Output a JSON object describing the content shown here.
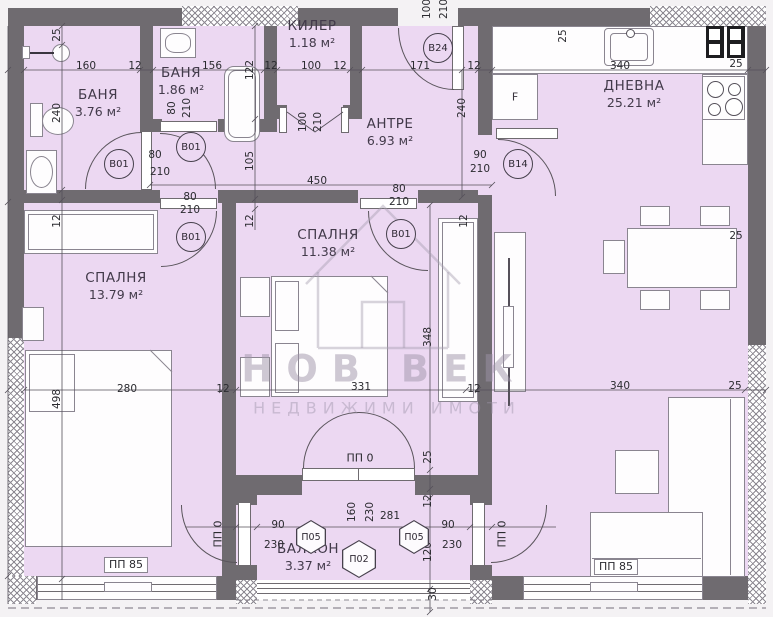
{
  "colors": {
    "floor": "#ecd8f2",
    "wall": "#6f6b70",
    "text": "#423a4a"
  },
  "watermark": {
    "line1": "НОВ ВЕК",
    "line2": "НЕДВИЖИМИ ИМОТИ"
  },
  "fixtures": {
    "fridge_label": "F"
  },
  "rooms": [
    {
      "id": "bath1",
      "name": "БАНЯ",
      "area": "3.76 м²",
      "lx": 98,
      "ly": 96
    },
    {
      "id": "bath2",
      "name": "БАНЯ",
      "area": "1.86 м²",
      "lx": 181,
      "ly": 74
    },
    {
      "id": "closet",
      "name": "КИЛЕР",
      "area": "1.18 м²",
      "lx": 312,
      "ly": 27
    },
    {
      "id": "hall",
      "name": "АНТРЕ",
      "area": "6.93 м²",
      "lx": 390,
      "ly": 125
    },
    {
      "id": "living",
      "name": "ДНЕВНА",
      "area": "25.21 м²",
      "lx": 634,
      "ly": 87
    },
    {
      "id": "bedroom1",
      "name": "СПАЛНЯ",
      "area": "13.79 м²",
      "lx": 116,
      "ly": 279
    },
    {
      "id": "bedroom2",
      "name": "СПАЛНЯ",
      "area": "11.38 м²",
      "lx": 328,
      "ly": 236
    },
    {
      "id": "balcony",
      "name": "БАЛКОН",
      "area": "3.37 м²",
      "lx": 308,
      "ly": 550
    }
  ],
  "badges": [
    {
      "t": "B01",
      "x": 118,
      "y": 163
    },
    {
      "t": "B01",
      "x": 190,
      "y": 146
    },
    {
      "t": "B01",
      "x": 190,
      "y": 236
    },
    {
      "t": "B01",
      "x": 400,
      "y": 233
    },
    {
      "t": "B24",
      "x": 437,
      "y": 47
    },
    {
      "t": "B14",
      "x": 517,
      "y": 163
    }
  ],
  "panels": [
    {
      "t": "П05",
      "x": 311,
      "y": 537,
      "w": 30,
      "h": 34
    },
    {
      "t": "П02",
      "x": 359,
      "y": 559,
      "w": 34,
      "h": 38
    },
    {
      "t": "П05",
      "x": 414,
      "y": 537,
      "w": 30,
      "h": 34
    }
  ],
  "opening_labels": [
    {
      "t": "ПП 85",
      "x": 126,
      "y": 565,
      "boxed": true
    },
    {
      "t": "ПП 85",
      "x": 616,
      "y": 567,
      "boxed": true
    },
    {
      "t": "ПП 0",
      "x": 360,
      "y": 458
    },
    {
      "t": "ПП 0",
      "x": 218,
      "y": 534,
      "r": 1
    },
    {
      "t": "ПП 0",
      "x": 502,
      "y": 534,
      "r": 1
    }
  ],
  "dimensions": [
    {
      "t": "160",
      "x": 86,
      "y": 66
    },
    {
      "t": "12",
      "x": 135,
      "y": 66
    },
    {
      "t": "156",
      "x": 212,
      "y": 66
    },
    {
      "t": "12",
      "x": 271,
      "y": 66
    },
    {
      "t": "100",
      "x": 311,
      "y": 66
    },
    {
      "t": "12",
      "x": 340,
      "y": 66
    },
    {
      "t": "171",
      "x": 420,
      "y": 66
    },
    {
      "t": "12",
      "x": 474,
      "y": 66
    },
    {
      "t": "340",
      "x": 620,
      "y": 66
    },
    {
      "t": "25",
      "x": 736,
      "y": 64
    },
    {
      "t": "25",
      "x": 57,
      "y": 35,
      "r": 1
    },
    {
      "t": "240",
      "x": 57,
      "y": 113,
      "r": 1
    },
    {
      "t": "12",
      "x": 57,
      "y": 221,
      "r": 1
    },
    {
      "t": "498",
      "x": 57,
      "y": 399,
      "r": 1
    },
    {
      "t": "122",
      "x": 250,
      "y": 70,
      "r": 1
    },
    {
      "t": "105",
      "x": 250,
      "y": 161,
      "r": 1
    },
    {
      "t": "12",
      "x": 250,
      "y": 221,
      "r": 1
    },
    {
      "t": "80",
      "x": 172,
      "y": 108,
      "r": 1
    },
    {
      "t": "210",
      "x": 187,
      "y": 108,
      "r": 1
    },
    {
      "t": "100",
      "x": 427,
      "y": 9,
      "r": 1
    },
    {
      "t": "210",
      "x": 444,
      "y": 9,
      "r": 1
    },
    {
      "t": "100",
      "x": 303,
      "y": 122,
      "r": 1
    },
    {
      "t": "210",
      "x": 318,
      "y": 122,
      "r": 1
    },
    {
      "t": "25",
      "x": 563,
      "y": 36,
      "r": 1
    },
    {
      "t": "240",
      "x": 462,
      "y": 108,
      "r": 1
    },
    {
      "t": "80",
      "x": 155,
      "y": 155
    },
    {
      "t": "210",
      "x": 160,
      "y": 172
    },
    {
      "t": "80",
      "x": 190,
      "y": 197
    },
    {
      "t": "210",
      "x": 190,
      "y": 210
    },
    {
      "t": "80",
      "x": 399,
      "y": 189
    },
    {
      "t": "210",
      "x": 399,
      "y": 202
    },
    {
      "t": "90",
      "x": 480,
      "y": 155
    },
    {
      "t": "210",
      "x": 480,
      "y": 169
    },
    {
      "t": "450",
      "x": 317,
      "y": 181
    },
    {
      "t": "12",
      "x": 464,
      "y": 221,
      "r": 1
    },
    {
      "t": "280",
      "x": 127,
      "y": 389
    },
    {
      "t": "12",
      "x": 223,
      "y": 389
    },
    {
      "t": "331",
      "x": 361,
      "y": 387
    },
    {
      "t": "12",
      "x": 474,
      "y": 389
    },
    {
      "t": "340",
      "x": 620,
      "y": 386
    },
    {
      "t": "25",
      "x": 735,
      "y": 386
    },
    {
      "t": "348",
      "x": 428,
      "y": 337,
      "r": 1
    },
    {
      "t": "25",
      "x": 428,
      "y": 457,
      "r": 1
    },
    {
      "t": "12",
      "x": 428,
      "y": 501,
      "r": 1
    },
    {
      "t": "120",
      "x": 428,
      "y": 552,
      "r": 1
    },
    {
      "t": "30",
      "x": 433,
      "y": 594,
      "r": 1
    },
    {
      "t": "160",
      "x": 352,
      "y": 512,
      "r": 1
    },
    {
      "t": "230",
      "x": 370,
      "y": 512,
      "r": 1
    },
    {
      "t": "281",
      "x": 390,
      "y": 516
    },
    {
      "t": "90",
      "x": 278,
      "y": 525
    },
    {
      "t": "230",
      "x": 274,
      "y": 545
    },
    {
      "t": "90",
      "x": 448,
      "y": 525
    },
    {
      "t": "230",
      "x": 452,
      "y": 545
    },
    {
      "t": "25",
      "x": 736,
      "y": 236
    }
  ]
}
